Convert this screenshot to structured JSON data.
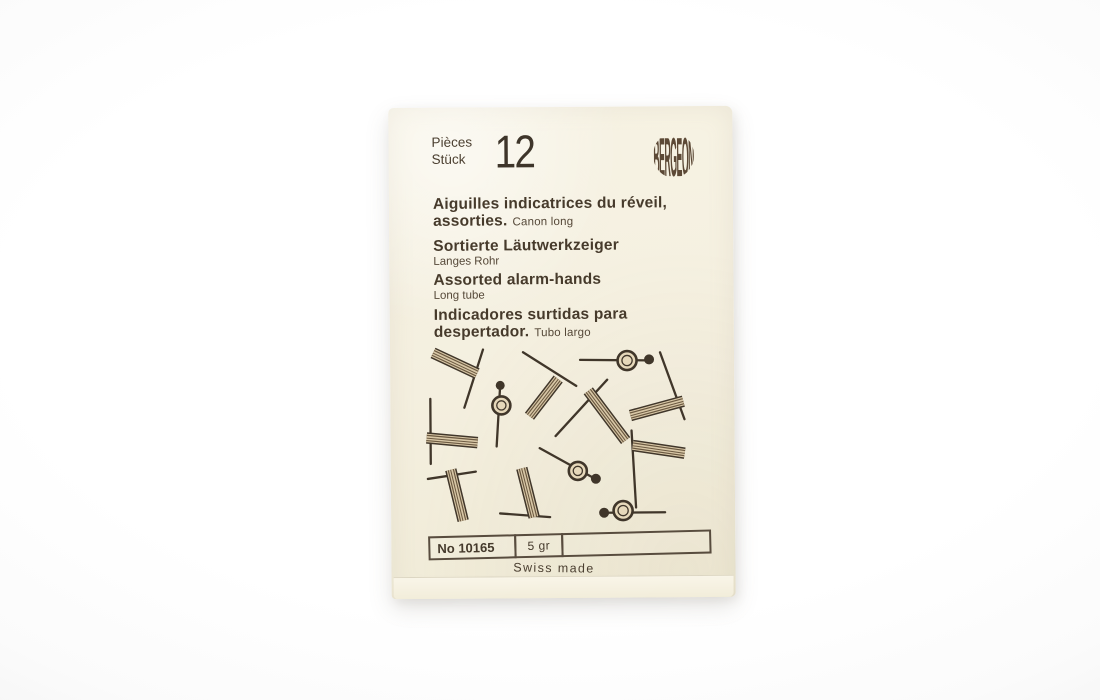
{
  "package": {
    "count_label_fr": "Pièces",
    "count_label_de": "Stück",
    "count_value": "12",
    "brand": "BERGEON",
    "titles": {
      "fr_line1": "Aiguilles indicatrices du réveil,",
      "fr_line2_bold": "assorties.",
      "fr_note": "Canon long",
      "de": "Sortierte Läutwerkzeiger",
      "de_note": "Langes Rohr",
      "en": "Assorted alarm-hands",
      "en_note": "Long tube",
      "es_line1": "Indicadores surtidas para",
      "es_line2_bold": "despertador.",
      "es_note": "Tubo largo"
    },
    "reference_table": {
      "ref_no": "No 10165",
      "weight": "5 gr",
      "blank_cell": ""
    },
    "origin": "Swiss made"
  },
  "colors": {
    "paper": "#f4efdf",
    "ink": "#40362a",
    "ink_light": "#5a4c3b",
    "tube_fill": "#d8c7a6",
    "tube_stripe": "#6b5941",
    "ring_fill": "#e6d8ba",
    "table_border": "#584c3e"
  },
  "illustration": {
    "viewbox": "0 0 320 200",
    "hands": [
      {
        "type": "tube",
        "tube": [
          14,
          16,
          58,
          37
        ],
        "needle": [
          64,
          13,
          45,
          71
        ]
      },
      {
        "type": "ring",
        "line": [
          81,
          48,
          77,
          110
        ],
        "ring": [
          82,
          69,
          9
        ],
        "dot": [
          81,
          49,
          4.5
        ]
      },
      {
        "type": "tube",
        "tube": [
          110,
          80,
          139,
          43
        ],
        "needle": [
          104,
          16,
          157,
          50
        ]
      },
      {
        "type": "ring",
        "line": [
          161,
          24,
          230,
          25
        ],
        "ring": [
          208,
          25,
          9.5
        ],
        "dot": [
          230,
          24,
          5
        ]
      },
      {
        "type": "tube",
        "tube": [
          211,
          80,
          264,
          66
        ],
        "needle": [
          241,
          17,
          265,
          84
        ]
      },
      {
        "type": "tube",
        "tube": [
          169,
          55,
          206,
          105
        ],
        "needle": [
          188,
          44,
          136,
          100
        ]
      },
      {
        "type": "tube",
        "tube": [
          7,
          101,
          58,
          106
        ],
        "needle": [
          11,
          62,
          11,
          127
        ]
      },
      {
        "type": "tube",
        "tube": [
          31,
          133,
          43,
          184
        ],
        "needle": [
          8,
          142,
          56,
          135
        ]
      },
      {
        "type": "tube",
        "tube": [
          102,
          132,
          114,
          181
        ],
        "needle": [
          80,
          177,
          130,
          181
        ]
      },
      {
        "type": "ring",
        "line": [
          120,
          112,
          177,
          144
        ],
        "ring": [
          158,
          135,
          9
        ],
        "dot": [
          176,
          143,
          5
        ]
      },
      {
        "type": "tube",
        "tube": [
          213,
          110,
          265,
          118
        ],
        "needle": [
          212,
          95,
          216,
          172
        ]
      },
      {
        "type": "ring",
        "line": [
          183,
          177,
          245,
          177
        ],
        "ring": [
          203,
          175,
          9.5
        ],
        "dot": [
          184,
          177,
          5
        ]
      }
    ]
  }
}
